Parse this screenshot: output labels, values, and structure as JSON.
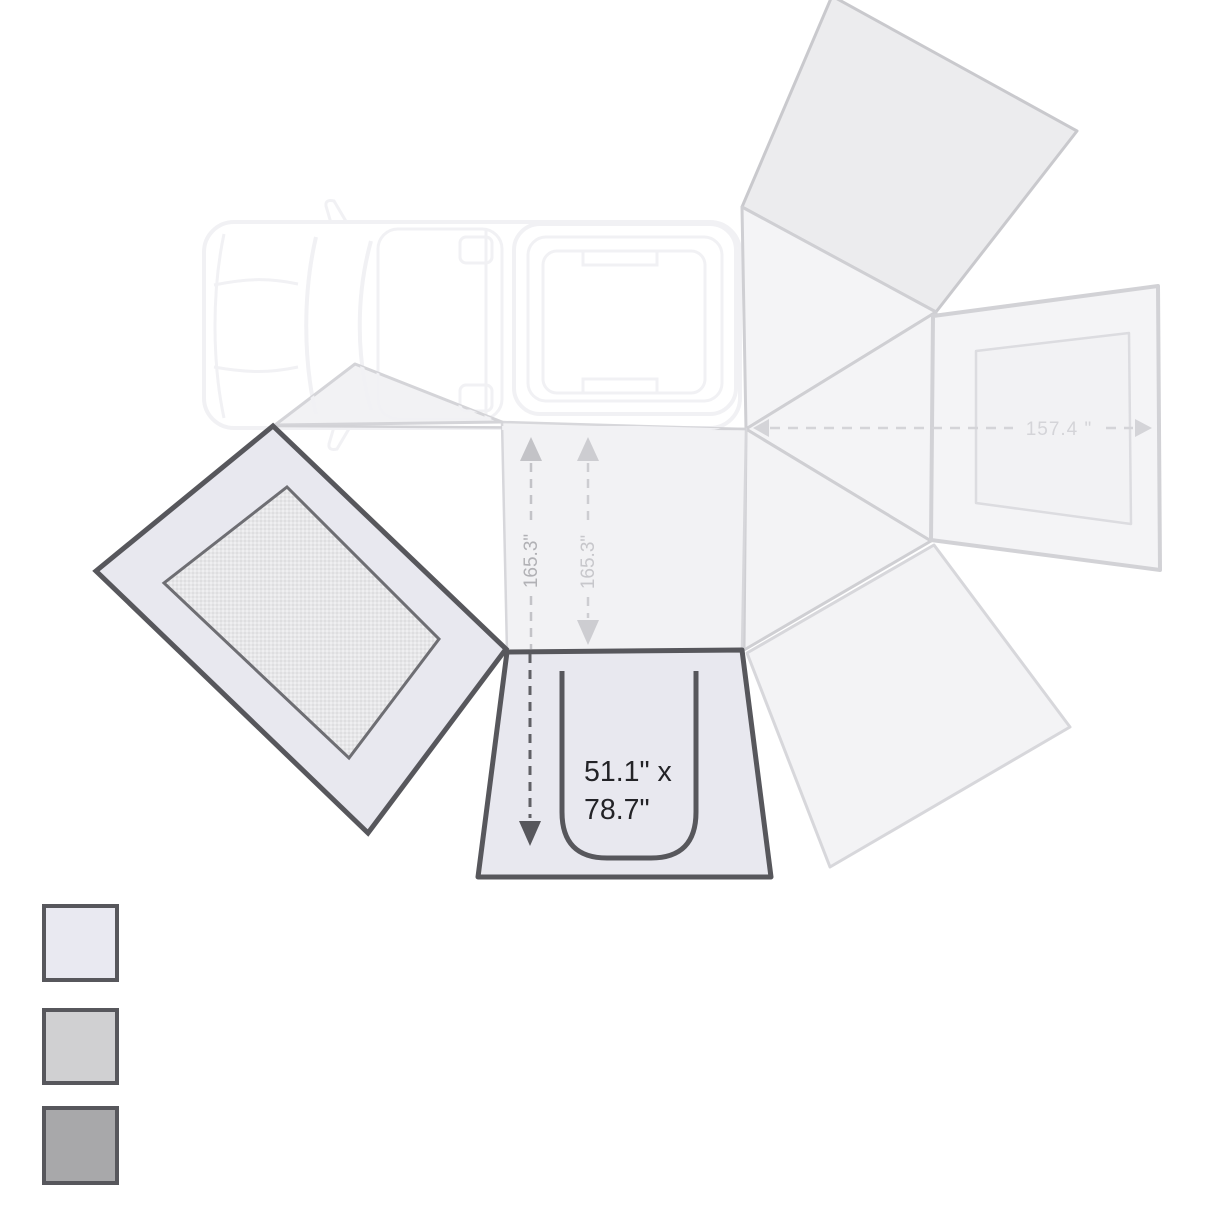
{
  "page": {
    "type": "product-dimension-diagram",
    "subject": "270-degree vehicle awning with wall panels, top view",
    "background": "#ffffff"
  },
  "labels": {
    "side_depth_1": "165.3\"",
    "side_depth_2": "165.3\"",
    "rear_width": "157.4 \"",
    "wall_size_line1": "51.1\" x",
    "wall_size_line2": "78.7\""
  },
  "colors": {
    "outline_dark": "#57575c",
    "panel_light_fill": "#f3f3f5",
    "panel_top_fill": "#ececee",
    "panel_lavender_fill": "#e8e8ef",
    "panel_light_stroke": "#cfcfd3",
    "guide_light": "#c3c3c7",
    "guide_lighter": "#d4d4d8",
    "guide_dark": "#606065",
    "car_ghost": "#f1f1f4",
    "dim_text_dark": "#232327",
    "dim_text_side1": "#b1b1b5",
    "dim_text_side2": "#c7c7cb"
  },
  "legend": {
    "swatches": [
      {
        "name": "fabric-light",
        "color": "#e9e9f1"
      },
      {
        "name": "fabric-medium",
        "color": "#d0d0d2"
      },
      {
        "name": "fabric-dark",
        "color": "#a8a8aa"
      }
    ]
  }
}
